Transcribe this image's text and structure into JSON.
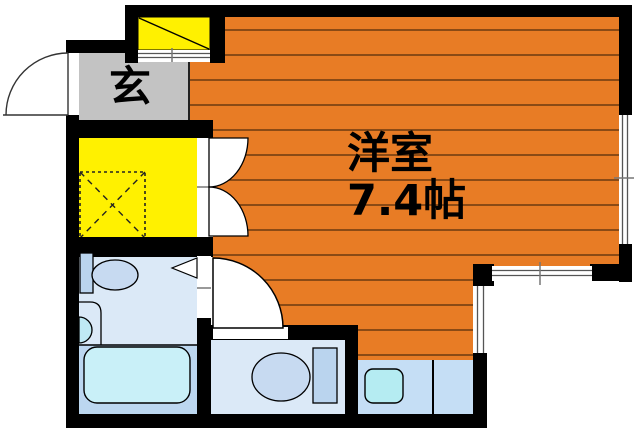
{
  "title": "apartment-floor-plan",
  "labels": {
    "entrance": "玄",
    "room_name": "洋室",
    "room_size": "7.4帖"
  },
  "colors": {
    "wall": "#000000",
    "room_floor": "#e87c25",
    "floor_stripe": "#6a3a10",
    "closet": "#fff100",
    "shoe_cabinet": "#fff100",
    "entrance_floor": "#c3c3c3",
    "washroom_floor": "#dbe9f7",
    "bath_floor": "#bcd7f0",
    "toilet_room_floor": "#dbe9f7",
    "kitchen_floor": "#c5def5",
    "bathtub": "#c9f0f8",
    "kitchen_sink": "#b5ecf2",
    "washbasin": "#bfe9f4",
    "fixture_light": "#c7daf1",
    "fixture_mid": "#bad4ee"
  }
}
